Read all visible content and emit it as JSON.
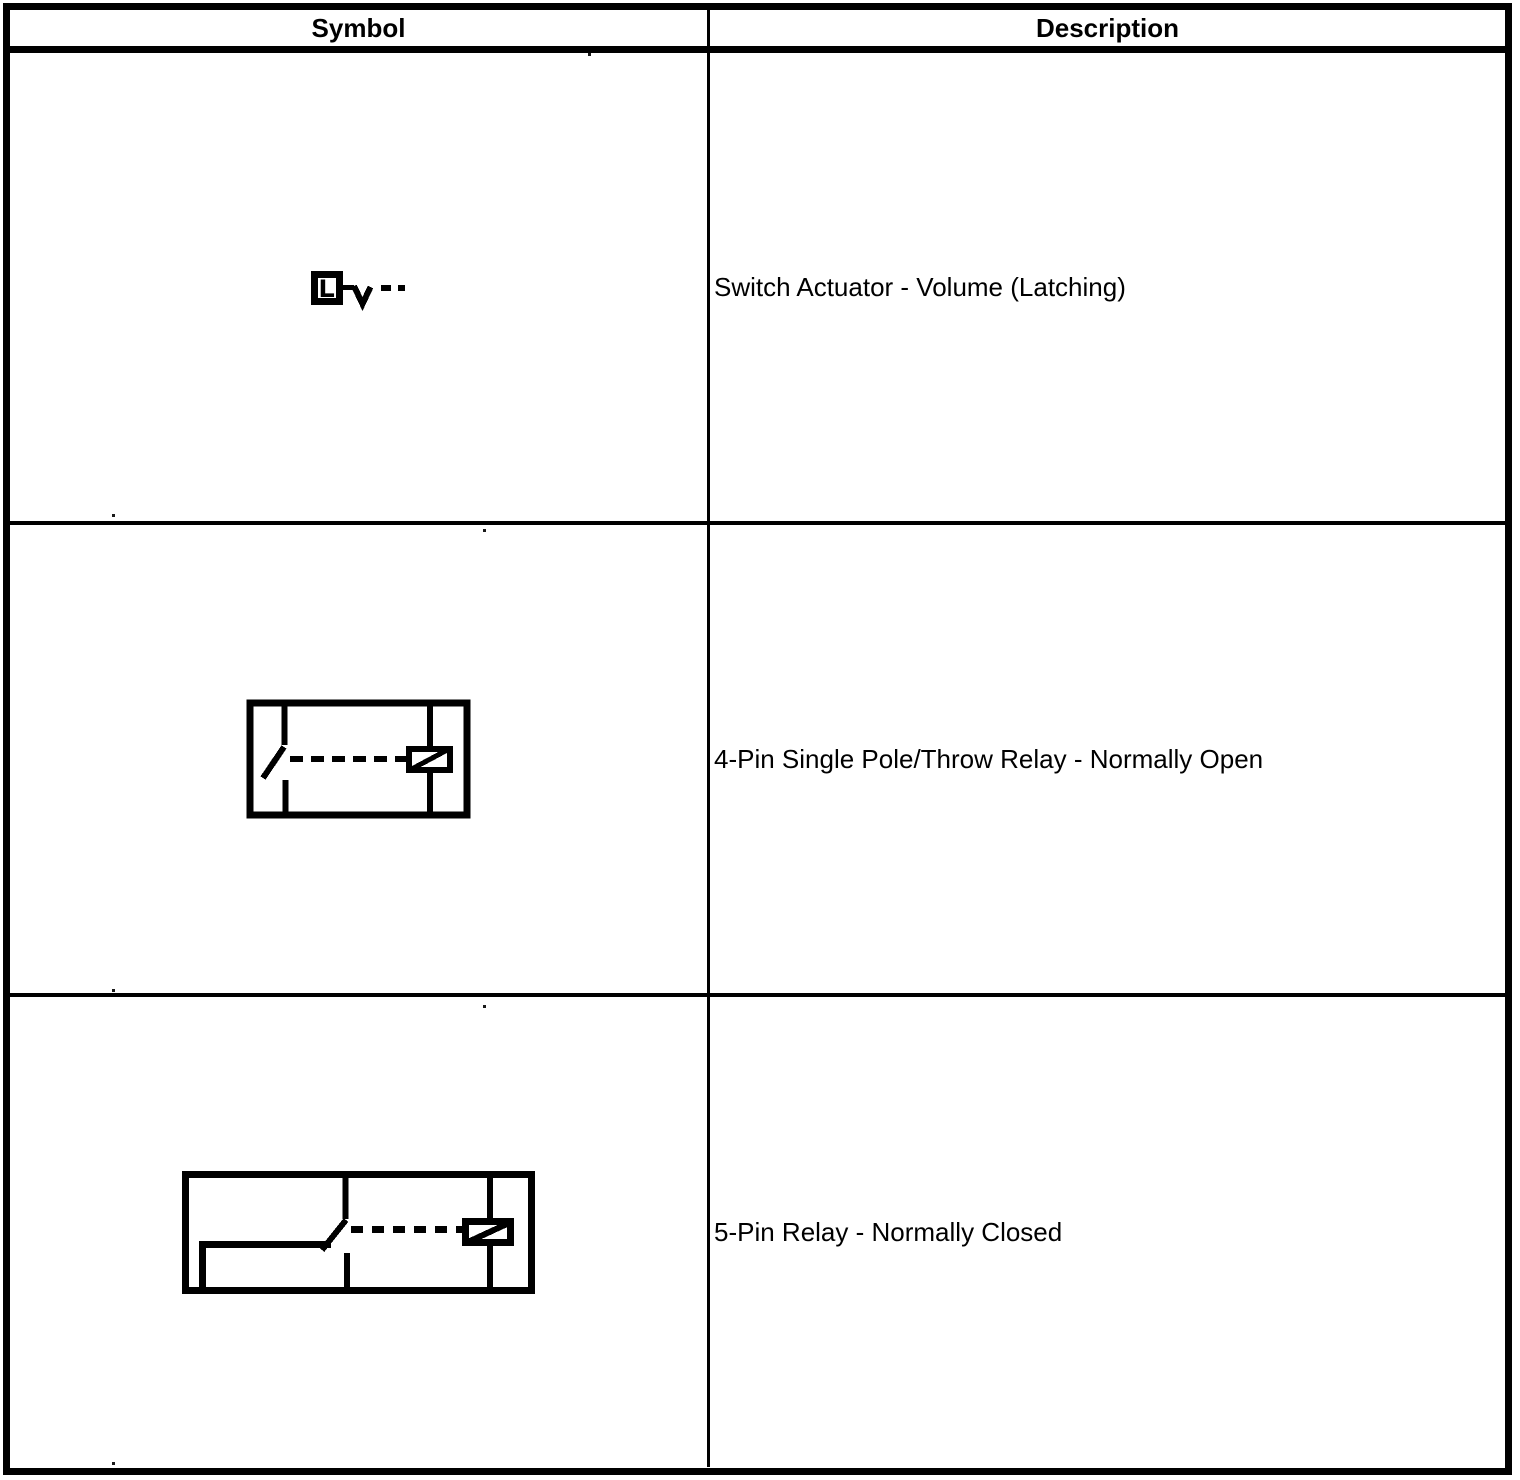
{
  "table": {
    "headers": {
      "symbol": "Symbol",
      "description": "Description"
    },
    "rows": [
      {
        "symbol_icon": "switch-actuator-volume-latching-symbol",
        "description": "Switch Actuator - Volume (Latching)"
      },
      {
        "symbol_icon": "4-pin-single-pole-throw-relay-normally-open-symbol",
        "description": "4-Pin Single Pole/Throw Relay - Normally Open"
      },
      {
        "symbol_icon": "5-pin-relay-normally-closed-symbol",
        "description": "5-Pin Relay - Normally Closed"
      }
    ]
  },
  "symbols": {
    "actuator_letter": "L"
  },
  "colors": {
    "ink": "#000000",
    "paper": "#ffffff"
  }
}
